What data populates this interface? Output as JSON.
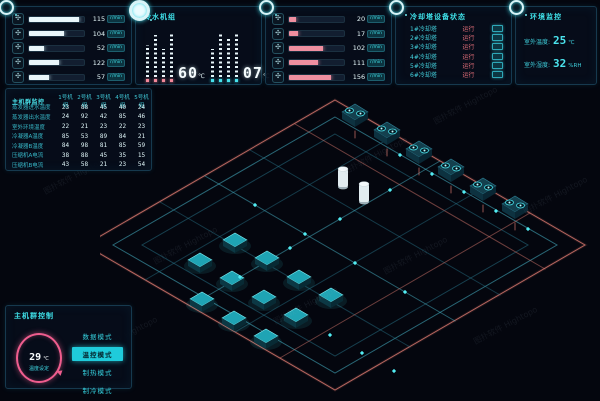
{
  "watermark": "图扑软件 Hightopo",
  "panels": {
    "pumps_left": {
      "unit": "r/min",
      "rows": [
        {
          "value": "115"
        },
        {
          "value": "104"
        },
        {
          "value": "52"
        },
        {
          "value": "122"
        },
        {
          "value": "57"
        }
      ]
    },
    "chiller": {
      "title": "冷水机组",
      "supply_value": "60",
      "supply_unit": "℃",
      "return_value": "07",
      "return_unit": "℃"
    },
    "pumps_right": {
      "unit": "r/min",
      "rows": [
        {
          "value": "20"
        },
        {
          "value": "17"
        },
        {
          "value": "102"
        },
        {
          "value": "111"
        },
        {
          "value": "156"
        }
      ]
    },
    "tower_status": {
      "title": "冷却塔设备状态",
      "rows": [
        {
          "name": "1#冷却塔",
          "status": "运行"
        },
        {
          "name": "2#冷却塔",
          "status": "运行"
        },
        {
          "name": "3#冷却塔",
          "status": "运行"
        },
        {
          "name": "4#冷却塔",
          "status": "运行"
        },
        {
          "name": "5#冷却塔",
          "status": "运行"
        },
        {
          "name": "6#冷却塔",
          "status": "运行"
        }
      ]
    },
    "env": {
      "title": "环境监控",
      "temp_label": "室外温度:",
      "temp_value": "25",
      "temp_unit": "℃",
      "hum_label": "室外湿度:",
      "hum_value": "32",
      "hum_unit": "%RH"
    }
  },
  "table": {
    "title": "主机群监控",
    "columns": [
      "1号机组",
      "2号机组",
      "3号机组",
      "4号机组",
      "5号机组"
    ],
    "rows": [
      {
        "label": "蒸发器进水温度",
        "values": [
          "23",
          "88",
          "45",
          "40",
          "24"
        ]
      },
      {
        "label": "蒸发器出水温度",
        "values": [
          "24",
          "92",
          "42",
          "85",
          "46"
        ]
      },
      {
        "label": "室外环境温度",
        "values": [
          "22",
          "21",
          "23",
          "22",
          "23"
        ]
      },
      {
        "label": "冷凝器A温度",
        "values": [
          "85",
          "53",
          "89",
          "84",
          "21"
        ]
      },
      {
        "label": "冷凝器B温度",
        "values": [
          "84",
          "98",
          "81",
          "85",
          "59"
        ]
      },
      {
        "label": "压缩机A电流",
        "values": [
          "38",
          "88",
          "45",
          "35",
          "15"
        ]
      },
      {
        "label": "压缩机B电流",
        "values": [
          "43",
          "58",
          "21",
          "23",
          "54"
        ]
      }
    ]
  },
  "control": {
    "title": "主机群控制",
    "gauge_value": "29",
    "gauge_unit": "℃",
    "gauge_label": "温度设定",
    "modes": [
      {
        "label": "数据模式"
      },
      {
        "label": "温控模式"
      },
      {
        "label": "制热模式"
      },
      {
        "label": "制冷模式"
      }
    ]
  },
  "colors": {
    "accent_cyan": "#3fe0e8",
    "accent_pink": "#ef5d8e",
    "pipe_salmon": "#d4766c",
    "pipe_cyan": "#49b8cc",
    "panel_border": "#16394e"
  }
}
